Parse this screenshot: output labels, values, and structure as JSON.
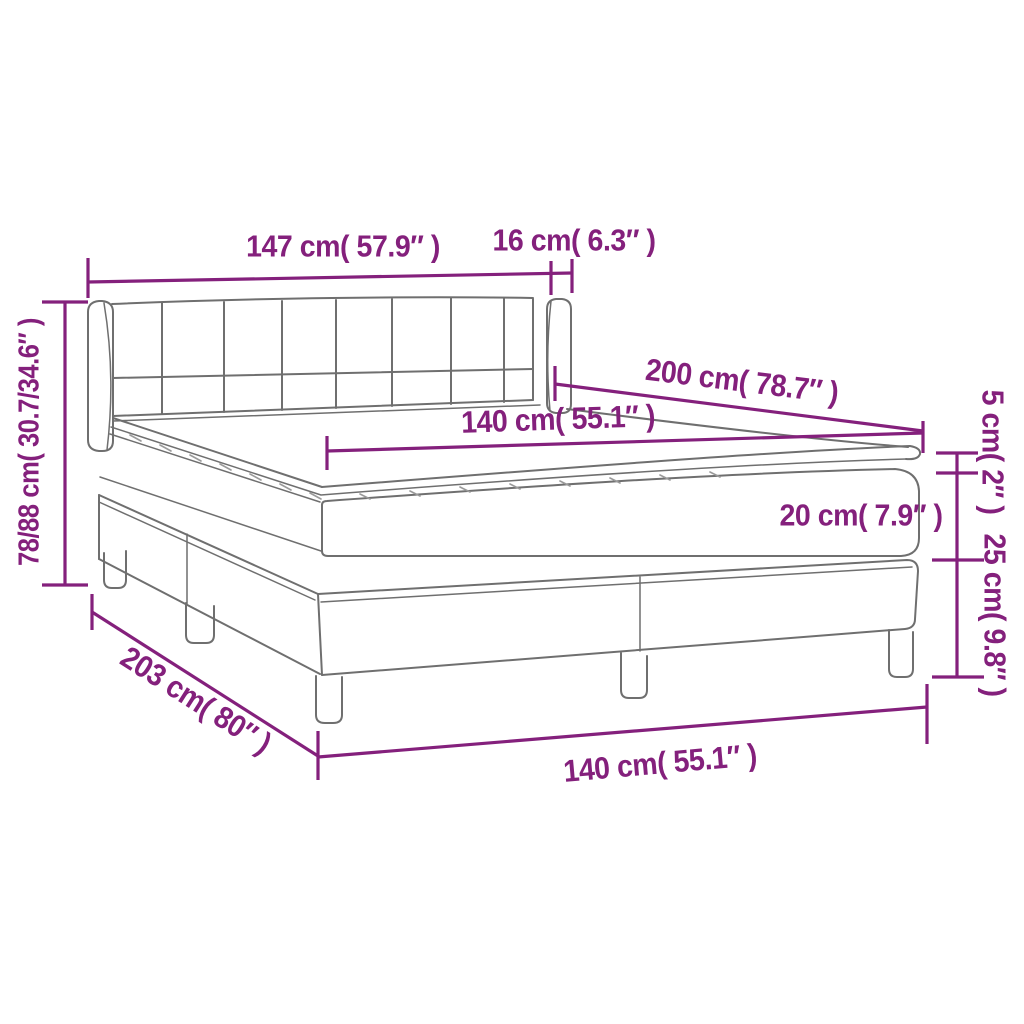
{
  "colors": {
    "accent": "#84207c",
    "line": "#6f6f6f",
    "hatch": "#9a9a9a",
    "background": "#ffffff"
  },
  "diagram": {
    "type": "product dimension diagram",
    "subject": "box spring bed with tufted headboard, mattress and topper",
    "unit_format": "cm( inches )"
  },
  "dimensions": [
    {
      "name": "headboard-width",
      "label": "147 cm( 57.9″ )"
    },
    {
      "name": "headboard-side-depth",
      "label": "16 cm( 6.3″ )"
    },
    {
      "name": "bed-length",
      "label": "200 cm( 78.7″ )"
    },
    {
      "name": "mattress-width",
      "label": "140 cm( 55.1″ )"
    },
    {
      "name": "topper-thickness",
      "label": "5 cm( 2″ )"
    },
    {
      "name": "mattress-thickness",
      "label": "20 cm( 7.9″ )"
    },
    {
      "name": "base-height",
      "label": "25 cm( 9.8″ )"
    },
    {
      "name": "overall-height",
      "label": "78/88 cm( 30.7/34.6″ )"
    },
    {
      "name": "base-length",
      "label": "203 cm( 80″ )"
    },
    {
      "name": "base-width",
      "label": "140 cm( 55.1″ )"
    }
  ]
}
